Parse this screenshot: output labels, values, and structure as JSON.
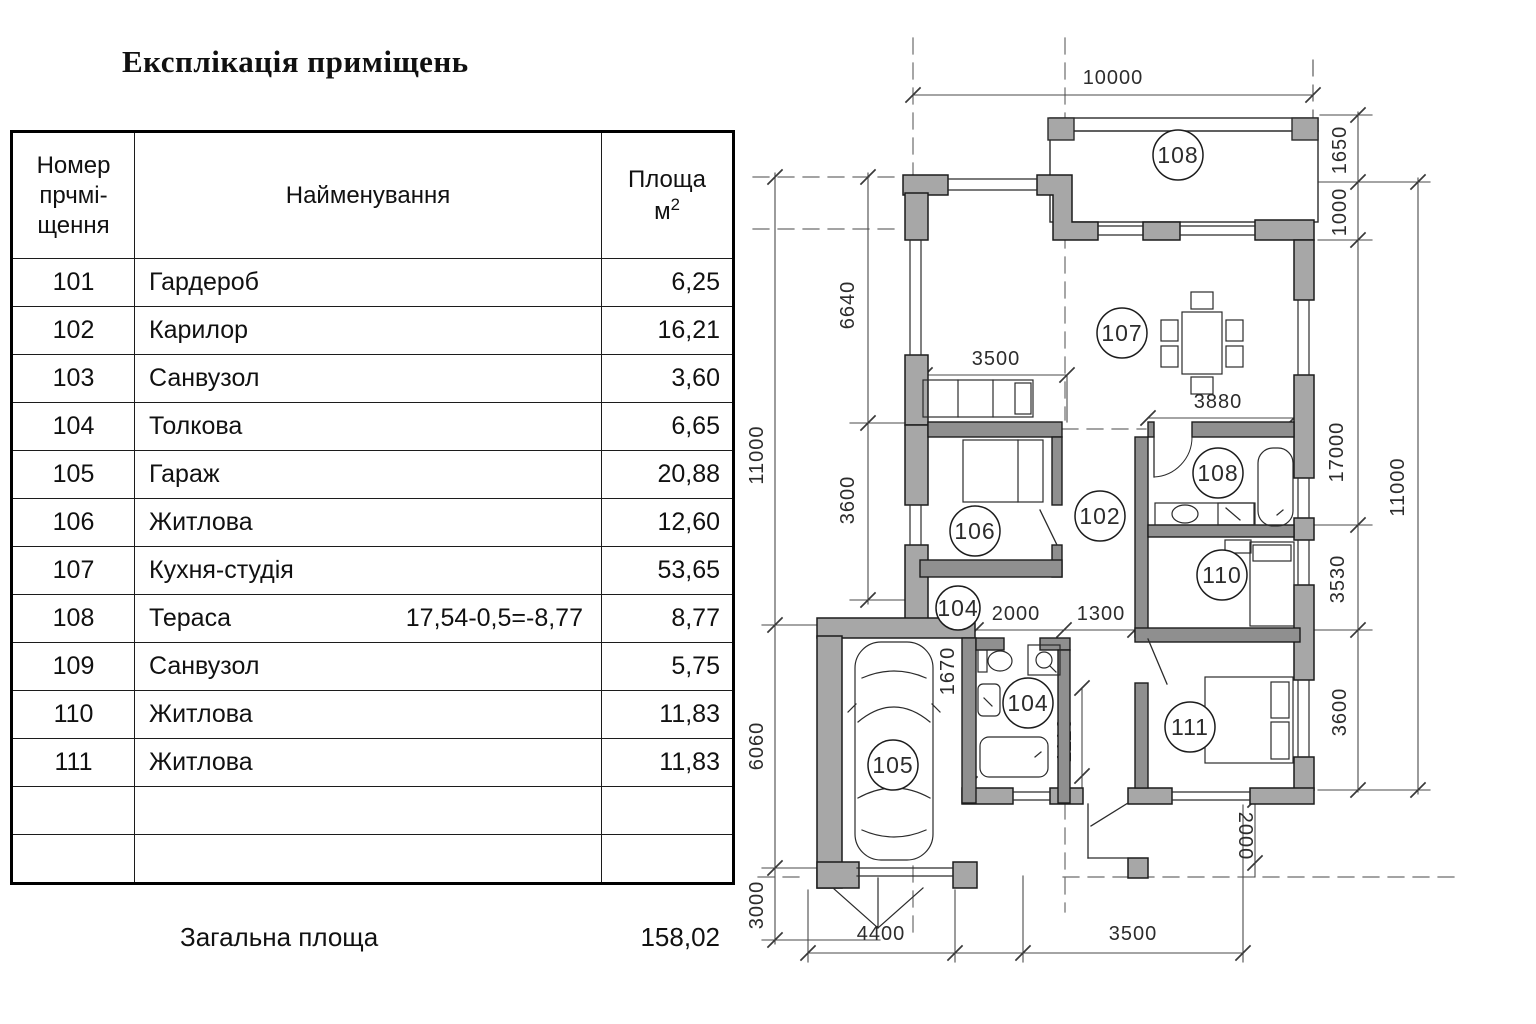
{
  "title": "Експлікація приміщень",
  "table": {
    "header": {
      "num_1": "Номер",
      "num_2": "прчмі-",
      "num_3": "щення",
      "name": "Найменування",
      "area_1": "Площа",
      "area_unit": "м",
      "area_sup": "2"
    },
    "rows": [
      {
        "num": "101",
        "name": "Гардероб",
        "note": "",
        "area": "6,25"
      },
      {
        "num": "102",
        "name": "Карилор",
        "note": "",
        "area": "16,21"
      },
      {
        "num": "103",
        "name": "Санвузол",
        "note": "",
        "area": "3,60"
      },
      {
        "num": "104",
        "name": "Толкова",
        "note": "",
        "area": "6,65"
      },
      {
        "num": "105",
        "name": "Гараж",
        "note": "",
        "area": "20,88"
      },
      {
        "num": "106",
        "name": "Житлова",
        "note": "",
        "area": "12,60"
      },
      {
        "num": "107",
        "name": "Кухня-студія",
        "note": "",
        "area": "53,65"
      },
      {
        "num": "108",
        "name": "Тераса",
        "note": "17,54-0,5=-8,77",
        "area": "8,77"
      },
      {
        "num": "109",
        "name": "Санвузол",
        "note": "",
        "area": "5,75"
      },
      {
        "num": "110",
        "name": "Житлова",
        "note": "",
        "area": "11,83"
      },
      {
        "num": "111",
        "name": "Житлова",
        "note": "",
        "area": "11,83"
      },
      {
        "num": "",
        "name": "",
        "note": "",
        "area": ""
      },
      {
        "num": "",
        "name": "",
        "note": "",
        "area": ""
      }
    ],
    "footer": {
      "label": "Загальна площа",
      "total": "158,02"
    }
  },
  "plan": {
    "rooms": {
      "terrace": "108",
      "kitchen": "107",
      "room106": "106",
      "corridor": "102",
      "bath_right": "108",
      "room110": "110",
      "hall": "104",
      "bath104": "104",
      "garage": "105",
      "room111": "111"
    },
    "dims": {
      "top": "10000",
      "right_1650": "1650",
      "right_1000": "1000",
      "right_17000": "17000",
      "right_3530": "3530",
      "right_3600": "3600",
      "right_outer": "11000",
      "left_outer": "11000",
      "left_6060": "6060",
      "left_3000": "3000",
      "left_6640": "6640",
      "left_3600": "3600",
      "sofa_3500": "3500",
      "table_3880": "3880",
      "hall_2000": "2000",
      "hall_1300": "1300",
      "garage_1670": "1670",
      "small_1110": "1110",
      "porch_2000": "2000",
      "bottom_4400": "4400",
      "bottom_3500": "3500"
    },
    "colors": {
      "wall_fill": "#a7a7a7",
      "inner_wall": "#8f8f8f",
      "line": "#2b2b2b",
      "dim": "#4a4a4a"
    }
  }
}
